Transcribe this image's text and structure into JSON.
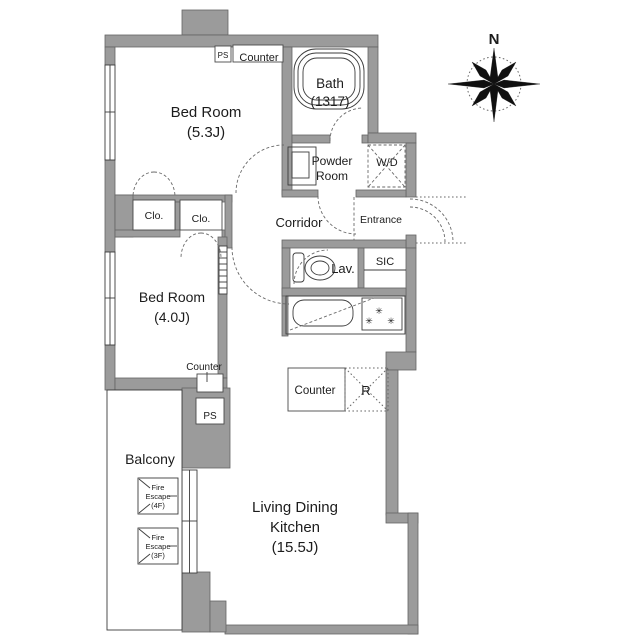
{
  "plan": {
    "rooms": {
      "bedroom1": {
        "name": "Bed Room",
        "size": "(5.3J)"
      },
      "bedroom2": {
        "name": "Bed Room",
        "size": "(4.0J)"
      },
      "bath": {
        "name": "Bath",
        "size": "(1317)"
      },
      "powder_room": {
        "line1": "Powder",
        "line2": "Room"
      },
      "corridor": {
        "label": "Corridor"
      },
      "entrance": {
        "label": "Entrance"
      },
      "closet1": {
        "label": "Clo."
      },
      "closet2": {
        "label": "Clo."
      },
      "lavatory": {
        "label": "Lav."
      },
      "sic": {
        "label": "SIC"
      },
      "ldk": {
        "line1": "Living Dining",
        "line2": "Kitchen",
        "size": "(15.5J)"
      },
      "balcony": {
        "label": "Balcony"
      }
    },
    "fixtures": {
      "ps_top": "PS",
      "counter_top": "Counter",
      "counter_mid": "Counter",
      "ps_mid": "PS",
      "counter_kitchen": "Counter",
      "refrigerator": "R",
      "washer_dryer": "W/D",
      "burner": "✳",
      "fire_escape_4f": {
        "line1": "Fire",
        "line2": "Escape",
        "line3": "(4F)"
      },
      "fire_escape_3f": {
        "line1": "Fire",
        "line2": "Escape",
        "line3": "(3F)"
      }
    },
    "compass": {
      "north": "N"
    },
    "colors": {
      "wall": "#9b9b9b",
      "wall_outline": "#646464",
      "line": "#3c3c3c",
      "text": "#1c1c1c",
      "background": "#ffffff"
    }
  }
}
